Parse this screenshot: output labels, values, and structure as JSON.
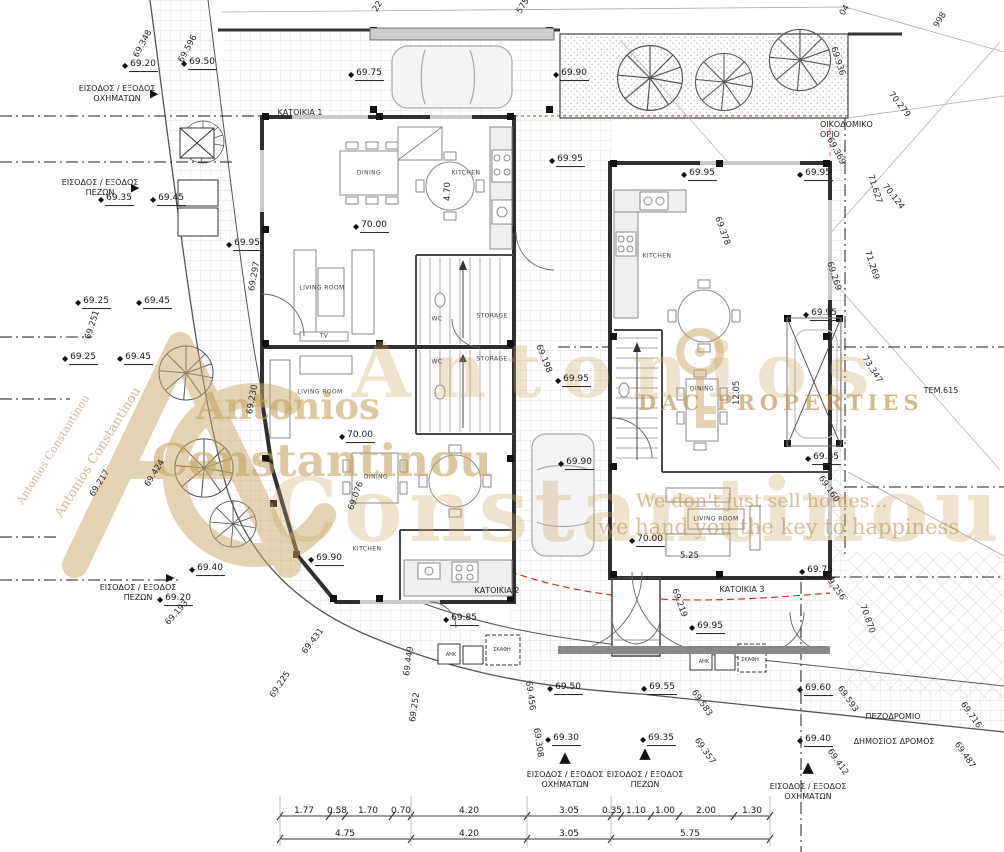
{
  "drawing_type": "architectural site / ground floor plan",
  "icons": {
    "spot_marker": "◆",
    "arrow_up": "▲",
    "arrow_right": "▶"
  },
  "colors": {
    "line": "#333333",
    "wall": "#2f2f2f",
    "grid": "#d9d9d9",
    "setback_red": "#c0392b",
    "watermark_tan": "#c9a86a",
    "paper": "#ffffff"
  },
  "watermark": {
    "vertical_name_1": "Antonios Constantinou",
    "vertical_name_2": "Antonios Constantinou",
    "name_top": "Antonios",
    "name_bottom": "Constantinou",
    "ghost_top": "Antonios",
    "ghost_bottom": "Constantinou",
    "brand": "DAC PROPERTIES",
    "slogan_1": "We don't just sell homes...",
    "slogan_2": "we hand you the key to happiness"
  },
  "unit_labels": [
    {
      "t": "ΚΑΤΟΙΚΙΑ 1",
      "x": 300,
      "y": 108
    },
    {
      "t": "ΚΑΤΟΙΚΙΑ 2",
      "x": 497,
      "y": 586
    },
    {
      "t": "ΚΑΤΟΙΚΙΑ 3",
      "x": 742,
      "y": 585
    }
  ],
  "site_labels": [
    {
      "t": "ΕΙΣΟΔΟΣ / ΕΞΟΔΟΣ\nΟΧΗΜΑΤΩΝ",
      "x": 117,
      "y": 84,
      "arrow": {
        "g": "right",
        "x": 150,
        "y": 88
      }
    },
    {
      "t": "ΕΙΣΟΔΟΣ / ΕΞΟΔΟΣ\nΠΕΖΩΝ",
      "x": 100,
      "y": 178,
      "arrow": {
        "g": "right",
        "x": 131,
        "y": 182
      }
    },
    {
      "t": "ΕΙΣΟΔΟΣ / ΕΞΟΔΟΣ\nΠΕΖΩΝ",
      "x": 138,
      "y": 583,
      "arrow": {
        "g": "right",
        "x": 166,
        "y": 572
      }
    },
    {
      "t": "ΕΙΣΟΔΟΣ / ΕΞΟΔΟΣ\nΟΧΗΜΑΤΩΝ",
      "x": 565,
      "y": 770,
      "arrow": {
        "g": "up",
        "x": 565,
        "y": 750
      }
    },
    {
      "t": "ΕΙΣΟΔΟΣ / ΕΞΟΔΟΣ\nΠΕΖΩΝ",
      "x": 645,
      "y": 770,
      "arrow": {
        "g": "up",
        "x": 645,
        "y": 746
      }
    },
    {
      "t": "ΕΙΣΟΔΟΣ / ΕΞΟΔΟΣ\nΟΧΗΜΑΤΩΝ",
      "x": 808,
      "y": 782,
      "arrow": {
        "g": "up",
        "x": 808,
        "y": 760
      }
    },
    {
      "t": "ΟΙΚΟΔΟΜΙΚΟ\nΟΡΙΟ",
      "x": 820,
      "y": 120,
      "align": "left"
    },
    {
      "t": "ΠΕΖΟΔΡΟΜΙΟ",
      "x": 893,
      "y": 712
    },
    {
      "t": "ΔΗΜΟΣΙΟΣ ΔΡΟΜΟΣ",
      "x": 894,
      "y": 737
    },
    {
      "t": "ΤΕΜ.615",
      "x": 941,
      "y": 386
    }
  ],
  "room_labels": [
    {
      "t": "KITCHEN",
      "x": 466,
      "y": 173
    },
    {
      "t": "DINING",
      "x": 369,
      "y": 173
    },
    {
      "t": "LIVING ROOM",
      "x": 322,
      "y": 288
    },
    {
      "t": "TV",
      "x": 324,
      "y": 336
    },
    {
      "t": "WC",
      "x": 437,
      "y": 319
    },
    {
      "t": "STORAGE",
      "x": 492,
      "y": 316
    },
    {
      "t": "WC",
      "x": 437,
      "y": 362
    },
    {
      "t": "STORAGE",
      "x": 492,
      "y": 359
    },
    {
      "t": "LIVING ROOM",
      "x": 320,
      "y": 392
    },
    {
      "t": "DINING",
      "x": 376,
      "y": 477
    },
    {
      "t": "KITCHEN",
      "x": 367,
      "y": 549
    },
    {
      "t": "KITCHEN",
      "x": 657,
      "y": 256
    },
    {
      "t": "DINING",
      "x": 702,
      "y": 389
    },
    {
      "t": "LIVING ROOM",
      "x": 716,
      "y": 519
    }
  ],
  "utility_labels": [
    {
      "t": "ΑΗΚ",
      "x": 451,
      "y": 655
    },
    {
      "t": "ΣΚΑΦΗ",
      "x": 502,
      "y": 650
    },
    {
      "t": "ΑΗΚ",
      "x": 704,
      "y": 662
    },
    {
      "t": "ΣΚΑΦΗ",
      "x": 750,
      "y": 660
    }
  ],
  "spot_elevations": [
    {
      "v": "69.20",
      "x": 122,
      "y": 66
    },
    {
      "v": "69.50",
      "x": 181,
      "y": 64
    },
    {
      "v": "69.75",
      "x": 348,
      "y": 75
    },
    {
      "v": "69.90",
      "x": 553,
      "y": 75
    },
    {
      "v": "69.95",
      "x": 549,
      "y": 161
    },
    {
      "v": "69.95",
      "x": 681,
      "y": 175
    },
    {
      "v": "69.95",
      "x": 797,
      "y": 175
    },
    {
      "v": "69.35",
      "x": 98,
      "y": 200
    },
    {
      "v": "69.45",
      "x": 150,
      "y": 200
    },
    {
      "v": "69.95",
      "x": 226,
      "y": 245
    },
    {
      "v": "69.25",
      "x": 75,
      "y": 303
    },
    {
      "v": "69.45",
      "x": 136,
      "y": 303
    },
    {
      "v": "69.25",
      "x": 62,
      "y": 359
    },
    {
      "v": "69.45",
      "x": 117,
      "y": 359
    },
    {
      "v": "69.95",
      "x": 555,
      "y": 381
    },
    {
      "v": "69.95",
      "x": 803,
      "y": 315
    },
    {
      "v": "70.00",
      "x": 353,
      "y": 227
    },
    {
      "v": "70.00",
      "x": 339,
      "y": 437
    },
    {
      "v": "69.90",
      "x": 558,
      "y": 464
    },
    {
      "v": "70.00",
      "x": 629,
      "y": 541
    },
    {
      "v": "69.85",
      "x": 805,
      "y": 459
    },
    {
      "v": "69.90",
      "x": 308,
      "y": 560
    },
    {
      "v": "69.85",
      "x": 443,
      "y": 620
    },
    {
      "v": "69.40",
      "x": 189,
      "y": 570
    },
    {
      "v": "69.20",
      "x": 157,
      "y": 600
    },
    {
      "v": "69.95",
      "x": 689,
      "y": 628
    },
    {
      "v": "69.75",
      "x": 799,
      "y": 572
    },
    {
      "v": "69.50",
      "x": 547,
      "y": 689
    },
    {
      "v": "69.55",
      "x": 641,
      "y": 689
    },
    {
      "v": "69.30",
      "x": 545,
      "y": 740
    },
    {
      "v": "69.35",
      "x": 640,
      "y": 740
    },
    {
      "v": "69.60",
      "x": 797,
      "y": 690
    },
    {
      "v": "69.40",
      "x": 797,
      "y": 741
    }
  ],
  "chainage_labels": [
    {
      "v": "69.348",
      "x": 136,
      "y": 52,
      "deg": -62
    },
    {
      "v": "69.596",
      "x": 181,
      "y": 57,
      "deg": -62
    },
    {
      "v": "22",
      "x": 375,
      "y": 6,
      "deg": -58
    },
    {
      "v": "575",
      "x": 519,
      "y": 8,
      "deg": -58
    },
    {
      "v": "04",
      "x": 842,
      "y": 10,
      "deg": -58
    },
    {
      "v": "998",
      "x": 936,
      "y": 22,
      "deg": -58
    },
    {
      "v": "69.936",
      "x": 833,
      "y": 42,
      "deg": 72
    },
    {
      "v": "70.279",
      "x": 890,
      "y": 88,
      "deg": 52
    },
    {
      "v": "69.369",
      "x": 829,
      "y": 133,
      "deg": 62
    },
    {
      "v": "71.627",
      "x": 870,
      "y": 170,
      "deg": 72
    },
    {
      "v": "70.124",
      "x": 884,
      "y": 180,
      "deg": 52
    },
    {
      "v": "71.269",
      "x": 867,
      "y": 246,
      "deg": 72
    },
    {
      "v": "69.269",
      "x": 829,
      "y": 257,
      "deg": 72
    },
    {
      "v": "73.347",
      "x": 864,
      "y": 352,
      "deg": 58
    },
    {
      "v": "69.378",
      "x": 717,
      "y": 212,
      "deg": 70
    },
    {
      "v": "69.198",
      "x": 538,
      "y": 340,
      "deg": 68
    },
    {
      "v": "69.297",
      "x": 252,
      "y": 286,
      "deg": -80
    },
    {
      "v": "69.251",
      "x": 88,
      "y": 334,
      "deg": -72
    },
    {
      "v": "69.230",
      "x": 250,
      "y": 409,
      "deg": -80
    },
    {
      "v": "69.217",
      "x": 92,
      "y": 491,
      "deg": -58
    },
    {
      "v": "69.424",
      "x": 147,
      "y": 481,
      "deg": -58
    },
    {
      "v": "69.076",
      "x": 351,
      "y": 505,
      "deg": -70
    },
    {
      "v": "69.193",
      "x": 167,
      "y": 619,
      "deg": -48
    },
    {
      "v": "69.431",
      "x": 304,
      "y": 648,
      "deg": -52
    },
    {
      "v": "69.225",
      "x": 272,
      "y": 692,
      "deg": -56
    },
    {
      "v": "69.449",
      "x": 407,
      "y": 671,
      "deg": -82
    },
    {
      "v": "69.252",
      "x": 413,
      "y": 717,
      "deg": -82
    },
    {
      "v": "69.456",
      "x": 528,
      "y": 676,
      "deg": 82
    },
    {
      "v": "69.308",
      "x": 536,
      "y": 723,
      "deg": 82
    },
    {
      "v": "69.160",
      "x": 820,
      "y": 472,
      "deg": 55
    },
    {
      "v": "69.219",
      "x": 674,
      "y": 584,
      "deg": 70
    },
    {
      "v": "69.256",
      "x": 826,
      "y": 570,
      "deg": 55
    },
    {
      "v": "70.870",
      "x": 862,
      "y": 600,
      "deg": 70
    },
    {
      "v": "69.583",
      "x": 693,
      "y": 686,
      "deg": 55
    },
    {
      "v": "69.593",
      "x": 839,
      "y": 682,
      "deg": 55
    },
    {
      "v": "69.357",
      "x": 696,
      "y": 734,
      "deg": 55
    },
    {
      "v": "69.412",
      "x": 829,
      "y": 745,
      "deg": 55
    },
    {
      "v": "69.716",
      "x": 962,
      "y": 698,
      "deg": 55
    },
    {
      "v": "69.487",
      "x": 956,
      "y": 738,
      "deg": 55
    },
    {
      "v": "4.70",
      "x": 448,
      "y": 196,
      "deg": -90
    },
    {
      "v": "12.05",
      "x": 737,
      "y": 400,
      "deg": -90
    },
    {
      "v": "5.25",
      "x": 680,
      "y": 551,
      "deg": 0
    }
  ],
  "dimensions": {
    "rows": [
      {
        "y": 806,
        "items": [
          {
            "v": "1.77",
            "x": 304
          },
          {
            "v": "0.58",
            "x": 337
          },
          {
            "v": "1.70",
            "x": 368
          },
          {
            "v": "0.70",
            "x": 401
          },
          {
            "v": "4.20",
            "x": 469
          },
          {
            "v": "3.05",
            "x": 569
          },
          {
            "v": "0.35",
            "x": 612
          },
          {
            "v": "1.10",
            "x": 636
          },
          {
            "v": "1.00",
            "x": 665
          },
          {
            "v": "2.00",
            "x": 706
          },
          {
            "v": "1.30",
            "x": 752
          }
        ]
      },
      {
        "y": 829,
        "items": [
          {
            "v": "4.75",
            "x": 345
          },
          {
            "v": "4.20",
            "x": 469
          },
          {
            "v": "3.05",
            "x": 569
          },
          {
            "v": "5.75",
            "x": 690
          }
        ]
      }
    ]
  }
}
